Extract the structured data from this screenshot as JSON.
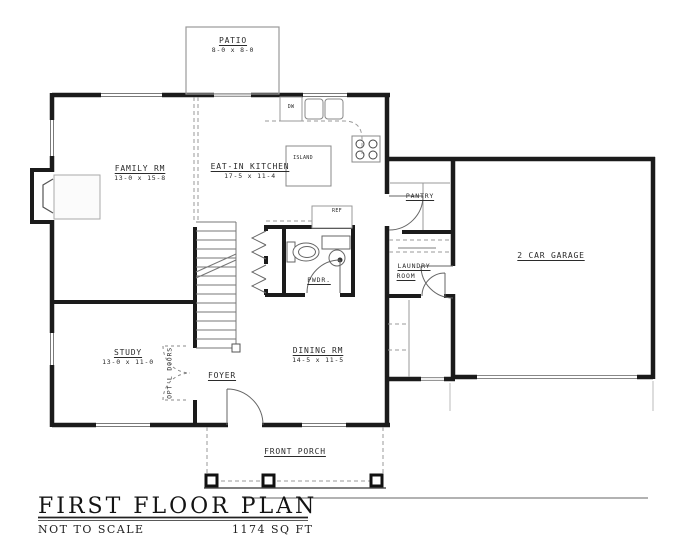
{
  "plan": {
    "rooms": {
      "patio": {
        "name": "PATIO",
        "dims": "8-0 x 8-0"
      },
      "family": {
        "name": "FAMILY RM",
        "dims": "13-0 x 15-8"
      },
      "kitchen": {
        "name": "EAT-IN KITCHEN",
        "dims": "17-5 x 11-4"
      },
      "island": {
        "name": "ISLAND"
      },
      "pantry": {
        "name": "PANTRY"
      },
      "garage": {
        "name": "2 CAR GARAGE"
      },
      "laundry": {
        "line1": "LAUNDRY",
        "line2": "ROOM"
      },
      "pwdr": {
        "name": "PWDR."
      },
      "study": {
        "name": "STUDY",
        "dims": "13-0 x 11-0"
      },
      "dining": {
        "name": "DINING RM",
        "dims": "14-5 x 11-5"
      },
      "foyer": {
        "name": "FOYER"
      },
      "porch": {
        "name": "FRONT PORCH"
      }
    },
    "fixtures": {
      "dishwasher": "DW",
      "refrigerator": "REF"
    },
    "annotations": {
      "optional_doors": "OPT'L DOORS"
    }
  },
  "title_block": {
    "title": "FIRST FLOOR PLAN",
    "scale_note": "NOT TO SCALE",
    "area": "1174 SQ FT"
  }
}
